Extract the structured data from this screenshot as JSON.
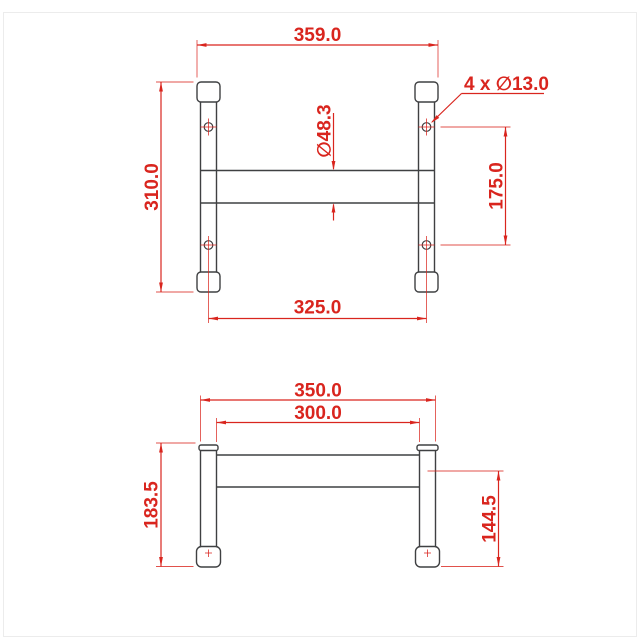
{
  "drawing": {
    "kind": "2D technical drawing, two orthographic views of a tubular H-frame",
    "colors": {
      "dimension_red": "#d9251e",
      "object_line": "#3f4042",
      "background": "#ffffff"
    },
    "views": {
      "top": {
        "name": "top-view",
        "dim_width_overall": "359.0",
        "dim_height_overall": "310.0",
        "dim_hole_spacing_horizontal": "325.0",
        "dim_hole_spacing_vertical": "175.0",
        "dim_tube_diameter": "∅48.3",
        "dim_hole_callout": "4 x ∅13.0"
      },
      "front": {
        "name": "front-view",
        "dim_width_overall": "350.0",
        "dim_inner_span": "300.0",
        "dim_height_overall": "183.5",
        "dim_bar_to_ground": "144.5"
      }
    }
  }
}
